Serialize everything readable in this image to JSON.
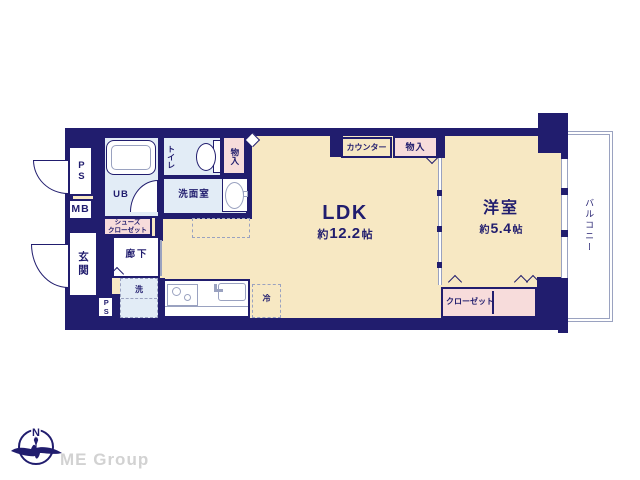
{
  "colors": {
    "navy": "#211d6e",
    "cream": "#f7e8c3",
    "pink": "#f7dcdb",
    "wet": "#e2ecf6",
    "line": "#9aa2c0",
    "textnavy": "#211d6e",
    "logogray": "#d2d2d2"
  },
  "rooms": {
    "ldk": {
      "label": "LDK",
      "size_prefix": "約",
      "size_value": "12.2",
      "size_unit": "帖"
    },
    "western": {
      "label": "洋室",
      "size_prefix": "約",
      "size_value": "5.4",
      "size_unit": "帖"
    },
    "balcony": {
      "label": "バルコニー"
    },
    "entrance": {
      "label": "玄関"
    },
    "hallway": {
      "label": "廊下"
    },
    "washroom": {
      "label": "洗面室"
    },
    "toilet": {
      "label": "トイレ"
    },
    "unit_bath": {
      "label": "UB"
    },
    "ps_top": {
      "label": "PS"
    },
    "meter_box": {
      "label": "MB"
    },
    "ps_bottom": {
      "label": "PS"
    },
    "shoes_closet": {
      "line1": "シューズ",
      "line2": "クローゼット"
    },
    "storage_hall": {
      "label": "物入"
    },
    "storage_ldk": {
      "label": "物入"
    },
    "counter": {
      "label": "カウンター"
    },
    "closet": {
      "label": "クローゼット"
    },
    "washer": {
      "label": "洗"
    },
    "fridge": {
      "label": "冷"
    }
  },
  "footer": {
    "logo_text": "ME Group",
    "compass_north": "N"
  }
}
